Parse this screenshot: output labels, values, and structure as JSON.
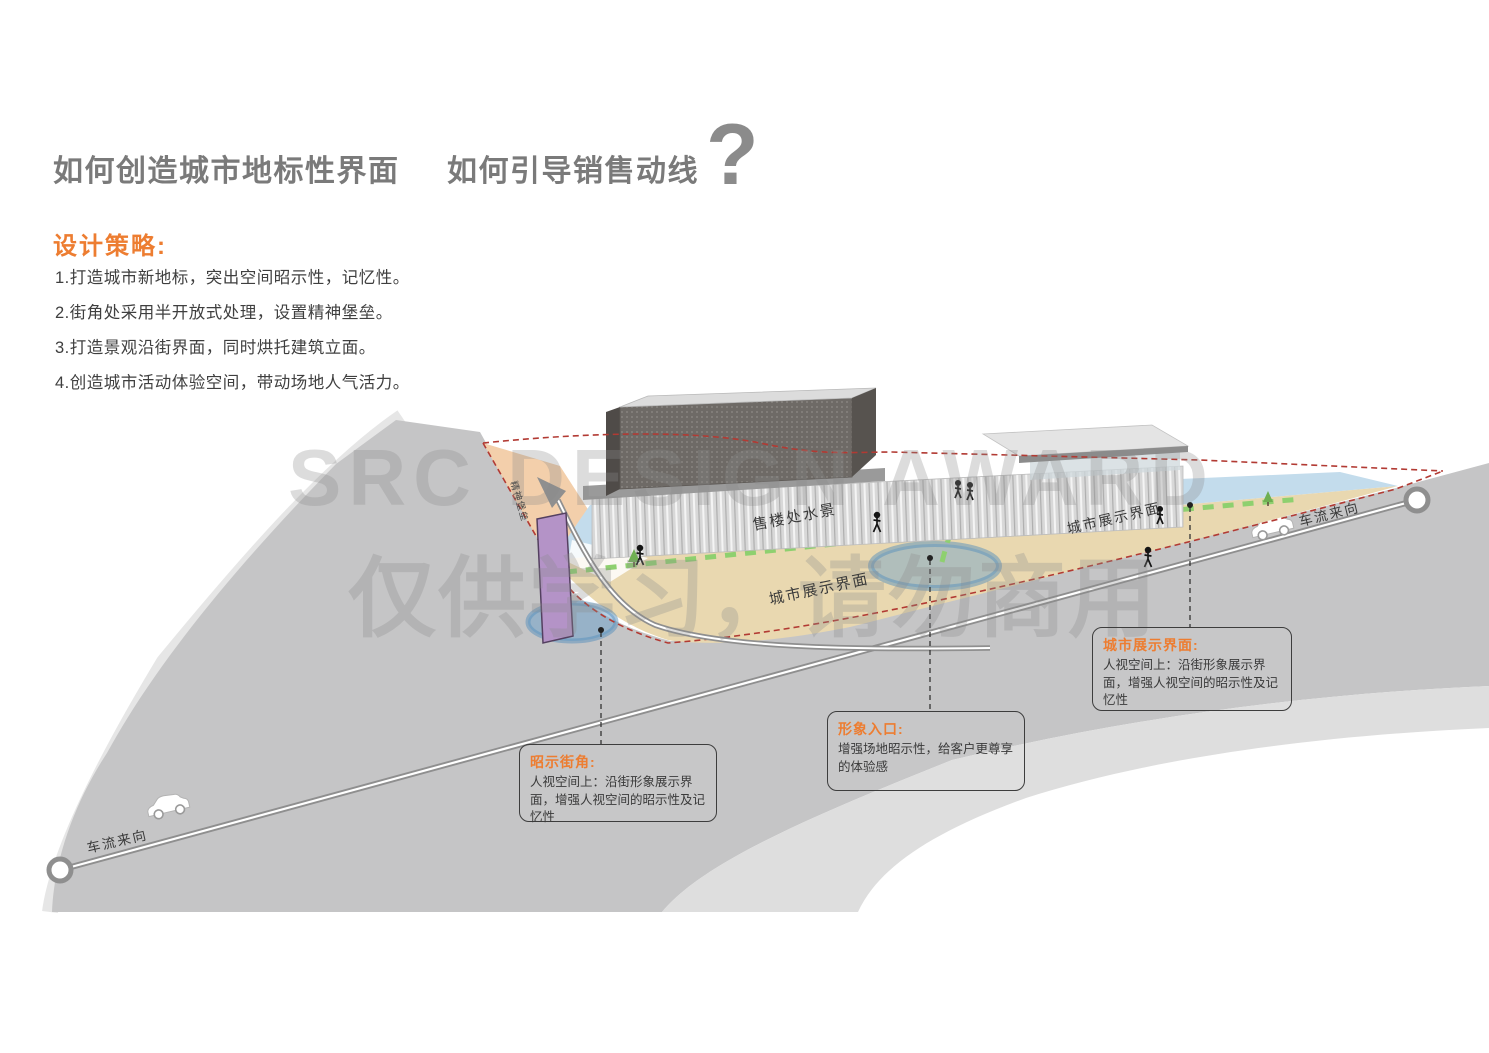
{
  "header": {
    "title_left": "如何创造城市地标性界面",
    "title_right": "如何引导销售动线",
    "question_mark": "?"
  },
  "strategy": {
    "heading": "设计策略:",
    "items": [
      "1.打造城市新地标，突出空间昭示性，记忆性。",
      "2.街角处采用半开放式处理，设置精神堡垒。",
      "3.打造景观沿街界面，同时烘托建筑立面。",
      "4.创造城市活动体验空间，带动场地人气活力。"
    ]
  },
  "watermark": {
    "line1": "SRC DESIGN AWARD",
    "line2": "仅供学习，请勿商用"
  },
  "diagram": {
    "labels": {
      "water_feature": "售楼处水景",
      "display_interface_center": "城市展示界面",
      "display_interface_right": "城市展示界面",
      "traffic_direction_right": "车流来向",
      "traffic_direction_left": "车流来向",
      "spirit_tower": "精神堡垒"
    },
    "callouts": [
      {
        "title": "昭示街角:",
        "body": "人视空间上：沿街形象展示界面，增强人视空间的昭示性及记忆性"
      },
      {
        "title": "形象入口:",
        "body": "增强场地昭示性，给客户更尊享的体验感"
      },
      {
        "title": "城市展示界面:",
        "body": "人视空间上：沿街形象展示界面，增强人视空间的昭示性及记忆性"
      }
    ]
  },
  "colors": {
    "accent_orange": "#ED7D31",
    "title_gray": "#7A7A7A",
    "road_gray": "#C5C5C6",
    "secondary_road_gray": "#DEDEDE",
    "water_blue": "#C3DCEC",
    "sand_tan": "#E9D8B0",
    "peach": "#F3CFAB",
    "purple_tower": "#B493C7",
    "path_green": "#8ED06F",
    "boundary_red": "#B23A33"
  }
}
